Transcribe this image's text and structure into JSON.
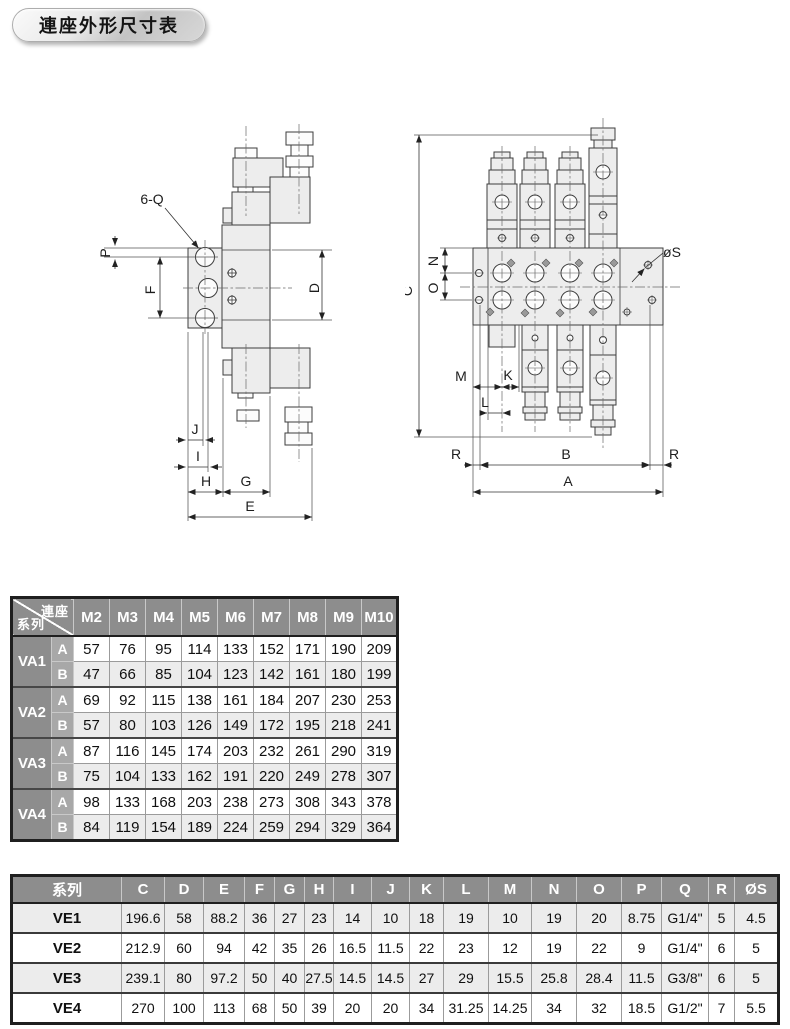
{
  "page_title": "連座外形尺寸表",
  "drawings": {
    "side_view": {
      "labels": {
        "q6": "6-Q",
        "p": "P",
        "f": "F",
        "d": "D",
        "j": "J",
        "i": "I",
        "h": "H",
        "g": "G",
        "e": "E"
      }
    },
    "front_view": {
      "labels": {
        "c": "C",
        "n": "N",
        "o": "O",
        "os": "øS",
        "m": "M",
        "k": "K",
        "l": "L",
        "r_left": "R",
        "b": "B",
        "r_right": "R",
        "a": "A"
      }
    }
  },
  "table_va": {
    "corner": {
      "top": "連座",
      "bottom": "系列"
    },
    "columns": [
      "M2",
      "M3",
      "M4",
      "M5",
      "M6",
      "M7",
      "M8",
      "M9",
      "M10"
    ],
    "groups": [
      {
        "name": "VA1",
        "rows": [
          {
            "label": "A",
            "values": [
              57,
              76,
              95,
              114,
              133,
              152,
              171,
              190,
              209
            ]
          },
          {
            "label": "B",
            "values": [
              47,
              66,
              85,
              104,
              123,
              142,
              161,
              180,
              199
            ]
          }
        ]
      },
      {
        "name": "VA2",
        "rows": [
          {
            "label": "A",
            "values": [
              69,
              92,
              115,
              138,
              161,
              184,
              207,
              230,
              253
            ]
          },
          {
            "label": "B",
            "values": [
              57,
              80,
              103,
              126,
              149,
              172,
              195,
              218,
              241
            ]
          }
        ]
      },
      {
        "name": "VA3",
        "rows": [
          {
            "label": "A",
            "values": [
              87,
              116,
              145,
              174,
              203,
              232,
              261,
              290,
              319
            ]
          },
          {
            "label": "B",
            "values": [
              75,
              104,
              133,
              162,
              191,
              220,
              249,
              278,
              307
            ]
          }
        ]
      },
      {
        "name": "VA4",
        "rows": [
          {
            "label": "A",
            "values": [
              98,
              133,
              168,
              203,
              238,
              273,
              308,
              343,
              378
            ]
          },
          {
            "label": "B",
            "values": [
              84,
              119,
              154,
              189,
              224,
              259,
              294,
              329,
              364
            ]
          }
        ]
      }
    ]
  },
  "table_ve": {
    "header_label": "系列",
    "columns": [
      "C",
      "D",
      "E",
      "F",
      "G",
      "H",
      "I",
      "J",
      "K",
      "L",
      "M",
      "N",
      "O",
      "P",
      "Q",
      "R",
      "ØS"
    ],
    "rows": [
      {
        "name": "VE1",
        "values": [
          "196.6",
          "58",
          "88.2",
          "36",
          "27",
          "23",
          "14",
          "10",
          "18",
          "19",
          "10",
          "19",
          "20",
          "8.75",
          "G1/4\"",
          "5",
          "4.5"
        ]
      },
      {
        "name": "VE2",
        "values": [
          "212.9",
          "60",
          "94",
          "42",
          "35",
          "26",
          "16.5",
          "11.5",
          "22",
          "23",
          "12",
          "19",
          "22",
          "9",
          "G1/4\"",
          "6",
          "5"
        ]
      },
      {
        "name": "VE3",
        "values": [
          "239.1",
          "80",
          "97.2",
          "50",
          "40",
          "27.5",
          "14.5",
          "14.5",
          "27",
          "29",
          "15.5",
          "25.8",
          "28.4",
          "11.5",
          "G3/8\"",
          "6",
          "5"
        ]
      },
      {
        "name": "VE4",
        "values": [
          "270",
          "100",
          "113",
          "68",
          "50",
          "39",
          "20",
          "20",
          "34",
          "31.25",
          "14.25",
          "34",
          "32",
          "18.5",
          "G1/2\"",
          "7",
          "5.5"
        ]
      }
    ]
  },
  "colors": {
    "table_header_bg": "#8d8d8d",
    "table_subheader_bg": "#a8a8a8",
    "row_alt_bg": "#ececec",
    "table_border_dark": "#1f1f1f"
  }
}
